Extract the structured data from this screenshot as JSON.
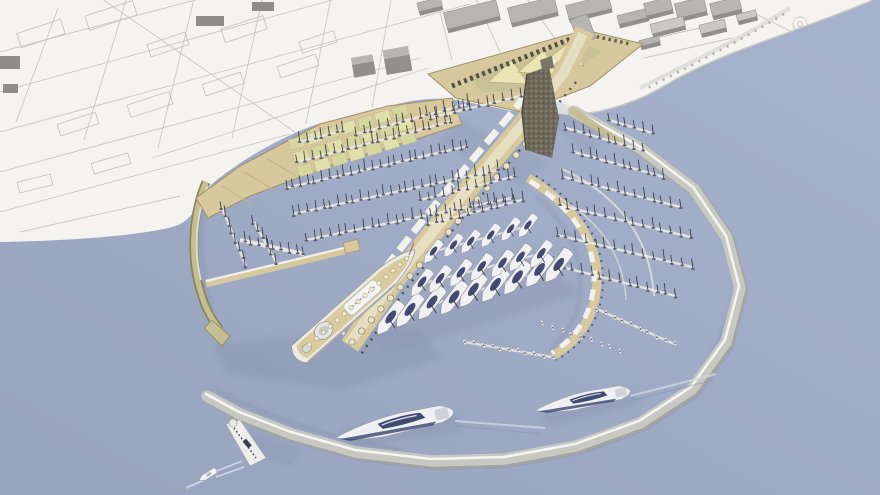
{
  "image_type": "architectural-3d-render",
  "subject": "circular-marina-port-masterplan-aerial-view",
  "palette": {
    "land": "#f4f3ef",
    "water1": "#98a3be",
    "water2": "#a7b2cd",
    "street": "#c7c6c2",
    "blockline": "#c0bfbb",
    "bTop": "#b6b5b1",
    "bSide": "#908f8b",
    "bLight": "#c9c8c4",
    "bMini": "#8d8c89",
    "quay": "#d7c89d",
    "quayEdge": "#a09068",
    "khaki": "#c4be92",
    "khakiEdge": "#8a8458",
    "olive": "#c8c296",
    "canopy": "#ebe5b3",
    "tree": "#45463a",
    "tower": "#6e695a",
    "towerDot": "#8f8a76",
    "pier": "#ededeb",
    "tick": "#a6a6a1",
    "mast": "#3e4046",
    "hullDot": "#5f6068",
    "navy": "#2e3966",
    "white": "#f1f2f3",
    "deck": "#d8cb9e",
    "shadow": "#8893ae",
    "road": "#dcdbd7",
    "green1": "#e1e0aa",
    "green2": "#d6d6a0",
    "wake": "#cdd4e3",
    "skylight": "#e9e2c8",
    "skyEdge": "#8a8266",
    "funnel": "#dddddb",
    "gray": "#c2c2bf"
  },
  "scene": {
    "streets": [
      [
        0,
        52,
        300,
        -28
      ],
      [
        0,
        92,
        390,
        -16
      ],
      [
        0,
        132,
        470,
        4
      ],
      [
        0,
        172,
        420,
        58
      ],
      [
        0,
        212,
        290,
        134
      ],
      [
        20,
        232,
        180,
        196
      ],
      [
        58,
        8,
        16,
        122
      ],
      [
        128,
        -6,
        84,
        140
      ],
      [
        198,
        -18,
        158,
        148
      ],
      [
        268,
        -28,
        232,
        138
      ],
      [
        338,
        -38,
        306,
        124
      ],
      [
        398,
        -40,
        372,
        108
      ],
      [
        92,
        -8,
        318,
        148
      ],
      [
        152,
        158,
        428,
        68
      ],
      [
        432,
        -20,
        452,
        60
      ],
      [
        472,
        -10,
        500,
        52
      ],
      [
        522,
        -8,
        556,
        40
      ],
      [
        612,
        48,
        700,
        28
      ],
      [
        644,
        58,
        732,
        38
      ],
      [
        756,
        14,
        820,
        46
      ],
      [
        772,
        40,
        836,
        18
      ]
    ],
    "blocks": [
      [
        18,
        26,
        46,
        15,
        -18
      ],
      [
        86,
        8,
        50,
        15,
        -18
      ],
      [
        148,
        38,
        40,
        13,
        -18
      ],
      [
        222,
        22,
        44,
        14,
        -18
      ],
      [
        58,
        118,
        40,
        12,
        -18
      ],
      [
        128,
        98,
        44,
        13,
        -18
      ],
      [
        203,
        78,
        40,
        12,
        -18
      ],
      [
        278,
        60,
        40,
        12,
        -18
      ],
      [
        18,
        178,
        34,
        11,
        -14
      ],
      [
        92,
        158,
        38,
        11,
        -16
      ],
      [
        300,
        36,
        36,
        12,
        -18
      ]
    ],
    "mini_buildings": [
      [
        0,
        56,
        20,
        13
      ],
      [
        3,
        84,
        15,
        9
      ],
      [
        196,
        16,
        28,
        10
      ],
      [
        252,
        2,
        22,
        9
      ]
    ],
    "buildings": [
      [
        418,
        0,
        24,
        12,
        -14,
        0
      ],
      [
        445,
        6,
        54,
        20,
        -14,
        0
      ],
      [
        509,
        2,
        48,
        19,
        -14,
        0
      ],
      [
        567,
        0,
        44,
        17,
        -14,
        0
      ],
      [
        618,
        12,
        30,
        12,
        -14,
        0
      ],
      [
        645,
        0,
        27,
        16,
        -14,
        0
      ],
      [
        676,
        0,
        30,
        18,
        -14,
        0
      ],
      [
        711,
        0,
        30,
        16,
        -14,
        0
      ],
      [
        651,
        20,
        34,
        13,
        -14,
        1
      ],
      [
        700,
        22,
        26,
        12,
        -14,
        1
      ],
      [
        737,
        12,
        20,
        10,
        -14,
        1
      ],
      [
        640,
        38,
        20,
        9,
        -14,
        0
      ],
      [
        352,
        56,
        22,
        16,
        -10,
        2
      ],
      [
        384,
        48,
        26,
        20,
        -10,
        2
      ]
    ],
    "breakwater_points": [
      [
        573,
        111
      ],
      [
        640,
        148
      ],
      [
        694,
        189
      ],
      [
        727,
        238
      ],
      [
        740,
        288
      ],
      [
        726,
        342
      ],
      [
        692,
        389
      ],
      [
        640,
        423
      ],
      [
        576,
        446
      ],
      [
        505,
        459
      ],
      [
        432,
        461
      ],
      [
        356,
        452
      ],
      [
        292,
        434
      ],
      [
        240,
        414
      ],
      [
        207,
        396
      ]
    ],
    "boat_rows": [
      [
        "m",
        298,
        162,
        452,
        121,
        22
      ],
      [
        "m",
        286,
        188,
        468,
        146,
        26
      ],
      [
        "m",
        293,
        214,
        498,
        170,
        28
      ],
      [
        "m",
        306,
        240,
        512,
        198,
        26
      ],
      [
        "m",
        356,
        134,
        468,
        104,
        15
      ],
      [
        "m",
        300,
        142,
        344,
        130,
        7
      ],
      [
        "m",
        222,
        208,
        246,
        266,
        8
      ],
      [
        "m",
        254,
        222,
        276,
        262,
        6
      ],
      [
        "m",
        244,
        241,
        304,
        254,
        9
      ],
      [
        "m",
        430,
        118,
        520,
        96,
        12
      ],
      [
        "m",
        420,
        200,
        516,
        176,
        13
      ],
      [
        "m",
        428,
        224,
        522,
        200,
        13
      ],
      [
        "m",
        566,
        128,
        642,
        150,
        10
      ],
      [
        "m",
        574,
        152,
        664,
        177,
        12
      ],
      [
        "m",
        564,
        177,
        680,
        207,
        14
      ],
      [
        "m",
        559,
        205,
        690,
        237,
        15
      ],
      [
        "m",
        557,
        235,
        692,
        267,
        15
      ],
      [
        "m",
        554,
        265,
        676,
        296,
        14
      ],
      [
        "m",
        609,
        120,
        652,
        133,
        6
      ],
      [
        "w",
        597,
        309,
        674,
        344,
        10
      ],
      [
        "w",
        543,
        324,
        620,
        350,
        9
      ],
      [
        "w",
        466,
        342,
        552,
        357,
        11
      ],
      [
        "y",
        388,
        318,
        558,
        266,
        9,
        1.3
      ],
      [
        "y",
        420,
        284,
        540,
        254,
        7,
        1.05
      ],
      [
        "y",
        432,
        252,
        528,
        226,
        6,
        0.9
      ]
    ],
    "shadows": [
      {
        "pts": [
          [
            213,
            344
          ],
          [
            420,
            328
          ],
          [
            442,
            358
          ],
          [
            340,
            390
          ],
          [
            228,
            374
          ]
        ],
        "o": 0.42
      },
      {
        "pts": [
          [
            368,
            332
          ],
          [
            560,
            274
          ],
          [
            580,
            294
          ],
          [
            388,
            354
          ]
        ],
        "o": 0.33
      },
      {
        "pts": [
          [
            452,
            118
          ],
          [
            548,
            162
          ],
          [
            522,
            188
          ],
          [
            440,
            142
          ]
        ],
        "o": 0.26
      },
      {
        "pts": [
          [
            560,
            100
          ],
          [
            606,
            138
          ],
          [
            588,
            156
          ],
          [
            545,
            118
          ]
        ],
        "o": 0.24
      },
      {
        "pts": [
          [
            340,
            430
          ],
          [
            456,
            414
          ],
          [
            462,
            432
          ],
          [
            350,
            448
          ]
        ],
        "o": 0.38
      },
      {
        "pts": [
          [
            540,
            414
          ],
          [
            634,
            392
          ],
          [
            640,
            404
          ],
          [
            548,
            426
          ]
        ],
        "o": 0.38
      },
      {
        "pts": [
          [
            250,
            432
          ],
          [
            302,
            450
          ],
          [
            292,
            466
          ],
          [
            246,
            452
          ]
        ],
        "o": 0.3
      },
      {
        "pts": [
          [
            322,
            124
          ],
          [
            432,
            104
          ],
          [
            438,
            118
          ],
          [
            328,
            138
          ]
        ],
        "o": 0.2
      }
    ],
    "lawn": {
      "x": 288,
      "y": 140,
      "cols": 7,
      "rows": 3,
      "cw": 15,
      "ch": 11,
      "gx": 18,
      "gy": 14,
      "rot": -17
    },
    "skylights": {
      "x1": 352,
      "y1": 342,
      "x2": 545,
      "y2": 122,
      "n": 21,
      "r": 3.2
    },
    "yachts": [
      {
        "x": 396,
        "y": 424,
        "rot": -12,
        "s": 1.0
      },
      {
        "x": 584,
        "y": 400,
        "rot": -11,
        "s": 0.8
      }
    ],
    "small_boat": {
      "x": 208,
      "y": 475,
      "rot": 148
    }
  }
}
